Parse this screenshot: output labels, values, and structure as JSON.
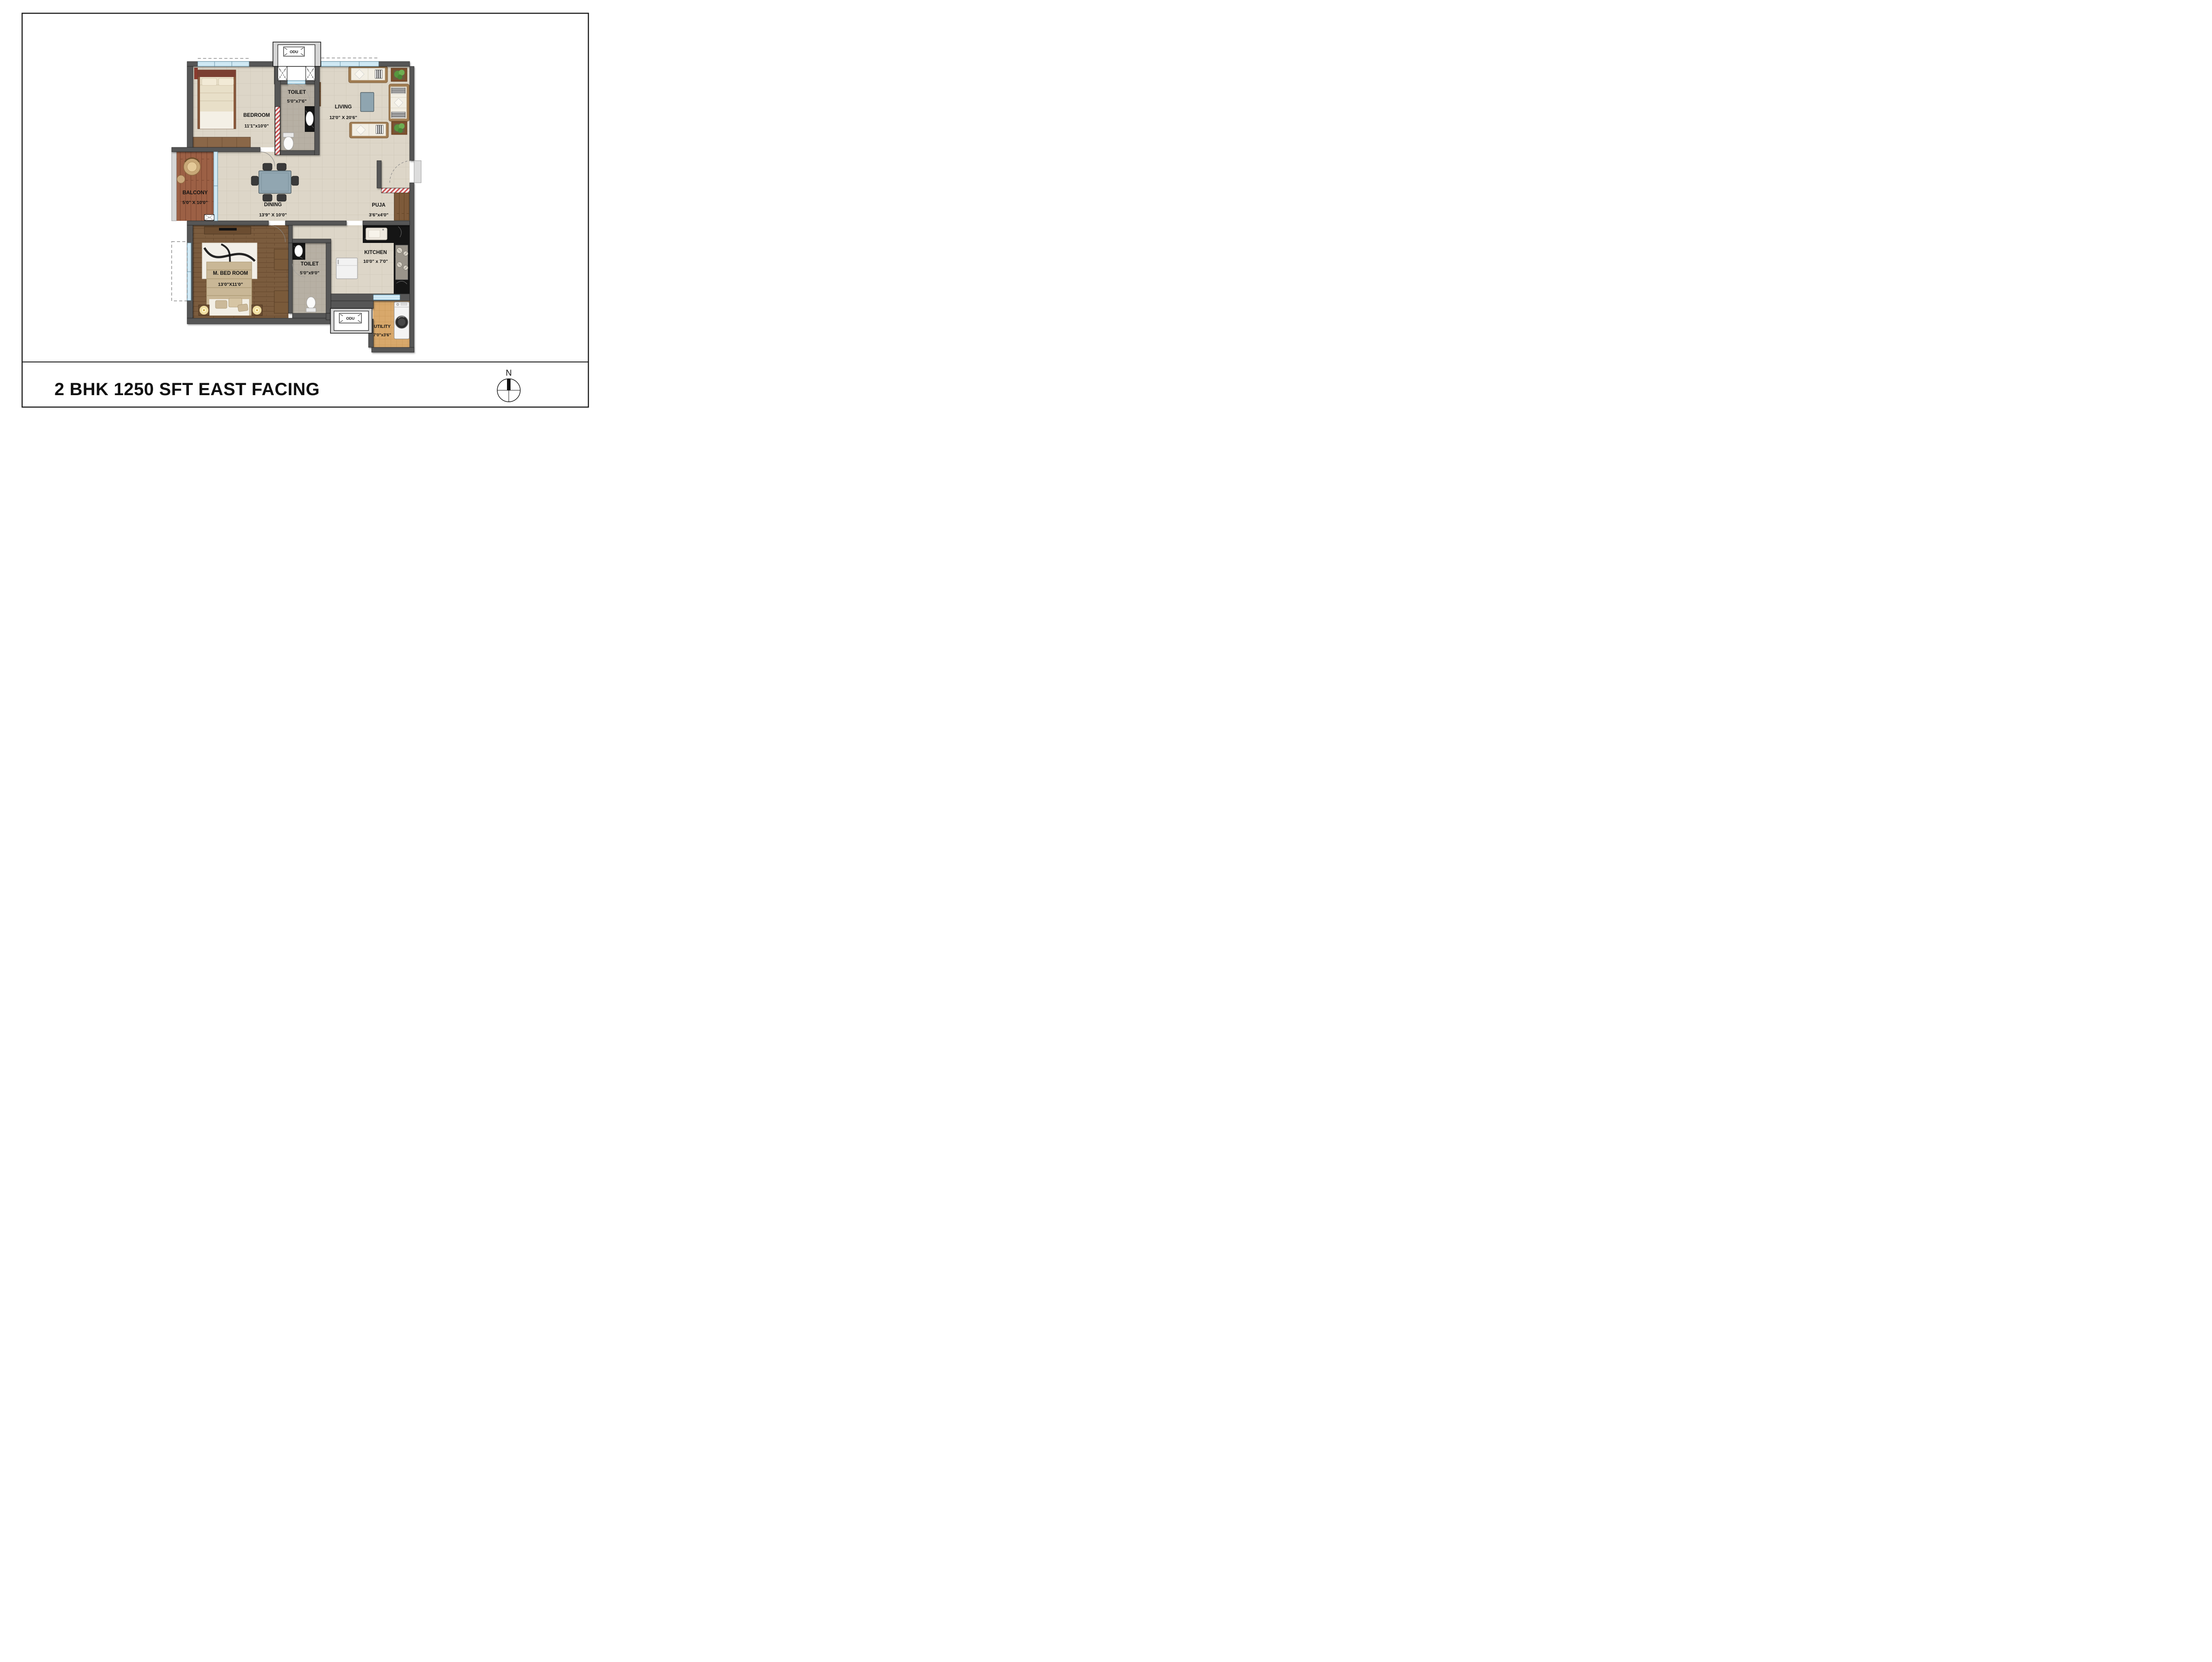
{
  "title": "2 BHK 1250 SFT EAST FACING",
  "compass": {
    "north_label": "N"
  },
  "odu": {
    "top_label": "ODU",
    "bottom_label": "ODU"
  },
  "rooms": {
    "bedroom": {
      "name": "BEDROOM",
      "dims": "11'1\"x10'0\""
    },
    "toilet_top": {
      "name": "TOILET",
      "dims": "5'0\"x7'6\""
    },
    "living": {
      "name": "LIVING",
      "dims": "12'0\" X 20'6\""
    },
    "balcony": {
      "name": "BALCONY",
      "dims": "5'0\" X 10'0\""
    },
    "dining": {
      "name": "DINING",
      "dims": "13'9\" X 10'0\""
    },
    "puja": {
      "name": "PUJA",
      "dims": "3'6\"x4'0\""
    },
    "master_bedroom": {
      "name": "M. BED ROOM",
      "dims": "13'0\"X11'0\""
    },
    "toilet_bottom": {
      "name": "TOILET",
      "dims": "5'0\"x9'0\""
    },
    "kitchen": {
      "name": "KITCHEN",
      "dims": "10'0\" x 7'0\""
    },
    "utility": {
      "name": "UTILITY",
      "dims": "7'0\"x3'6\""
    }
  },
  "colors": {
    "wall": "#565656",
    "floor_tile": "#ddd6c8",
    "toilet_tile": "#b7b0a4",
    "utility_tile": "#d8a86b",
    "master_wood": "#7b5c3e",
    "balcony_wood": "#9c6045",
    "window_blue": "#bfe0ef",
    "counter_black": "#151515",
    "hatch_red": "#c94f4f",
    "table_bluegray": "#91a6b1"
  }
}
